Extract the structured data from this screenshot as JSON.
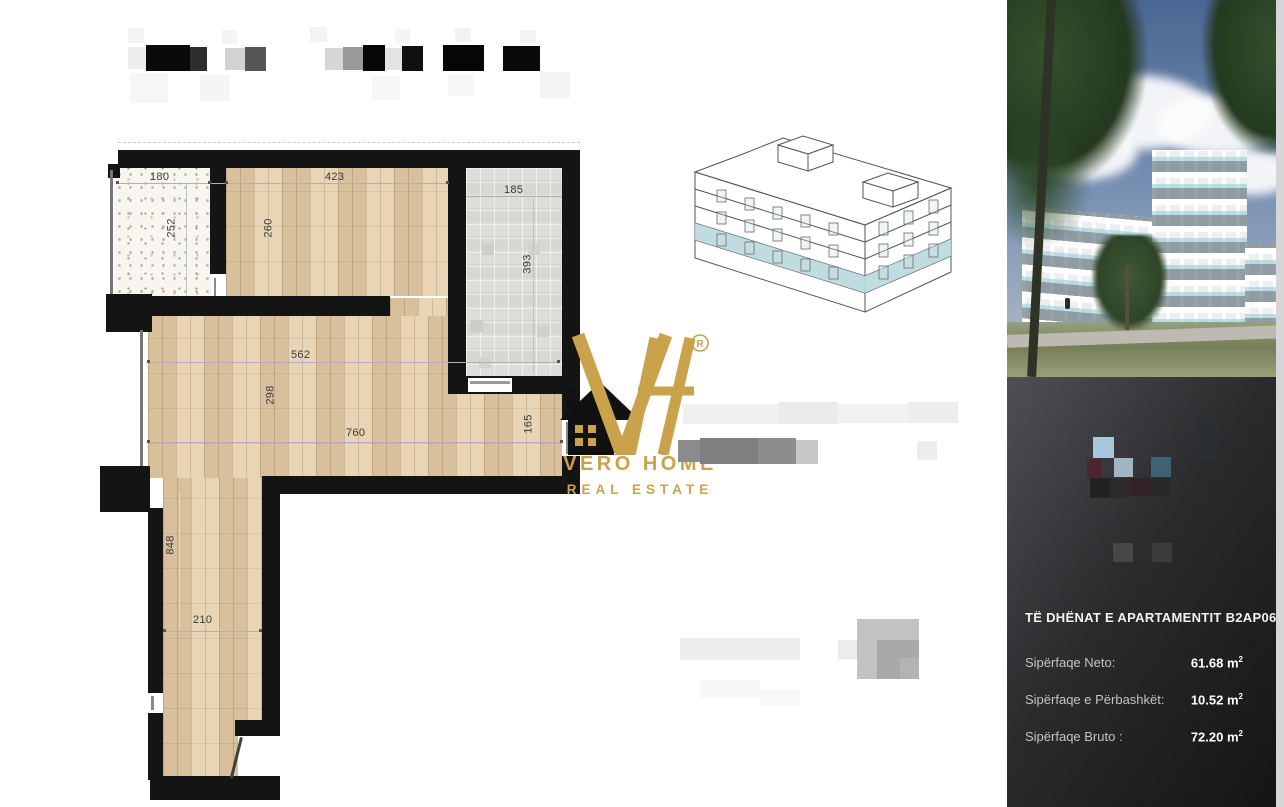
{
  "colors": {
    "gold": "#c9a24b",
    "wall_black": "#141414",
    "floor_wood": "#e6d0ae",
    "highlight_band": "#b9d8de",
    "panel_dark": "#2b2b2e"
  },
  "logo": {
    "monogram": "VH",
    "registered": "R",
    "line1": "VERO HOME",
    "line2": "REAL ESTATE"
  },
  "building_sketch": {
    "type": "axonometric-line-drawing",
    "highlight_band_color": "#b9d8de"
  },
  "floor_plan": {
    "dims": [
      "180",
      "423",
      "185",
      "252",
      "260",
      "393",
      "562",
      "298",
      "760",
      "165",
      "848",
      "210"
    ],
    "walls": [
      {
        "x": 118,
        "y": 150,
        "w": 462,
        "h": 18
      },
      {
        "x": 108,
        "y": 164,
        "w": 12,
        "h": 14
      },
      {
        "x": 110,
        "y": 170,
        "w": 3,
        "h": 136,
        "c": "#777777"
      },
      {
        "x": 106,
        "y": 294,
        "w": 46,
        "h": 38
      },
      {
        "x": 210,
        "y": 168,
        "w": 16,
        "h": 106
      },
      {
        "x": 214,
        "y": 278,
        "w": 2,
        "h": 18,
        "c": "#888888"
      },
      {
        "x": 448,
        "y": 150,
        "w": 18,
        "h": 240
      },
      {
        "x": 562,
        "y": 150,
        "w": 18,
        "h": 270
      },
      {
        "x": 562,
        "y": 456,
        "w": 18,
        "h": 38
      },
      {
        "x": 566,
        "y": 422,
        "w": 3,
        "h": 32,
        "c": "#888888"
      },
      {
        "x": 112,
        "y": 296,
        "w": 278,
        "h": 20
      },
      {
        "x": 448,
        "y": 376,
        "w": 132,
        "h": 18
      },
      {
        "x": 468,
        "y": 378,
        "w": 44,
        "h": 14,
        "c": "#ffffff"
      },
      {
        "x": 470,
        "y": 381,
        "w": 40,
        "h": 3,
        "c": "#999999"
      },
      {
        "x": 140,
        "y": 330,
        "w": 3,
        "h": 138,
        "c": "#777777"
      },
      {
        "x": 100,
        "y": 466,
        "w": 50,
        "h": 46
      },
      {
        "x": 262,
        "y": 476,
        "w": 318,
        "h": 18
      },
      {
        "x": 262,
        "y": 476,
        "w": 18,
        "h": 252
      },
      {
        "x": 235,
        "y": 720,
        "w": 45,
        "h": 16
      },
      {
        "x": 238,
        "y": 736,
        "w": 24,
        "h": 44,
        "c": "#ffffff"
      },
      {
        "x": 148,
        "y": 508,
        "w": 15,
        "h": 272
      },
      {
        "x": 150,
        "y": 776,
        "w": 130,
        "h": 24
      },
      {
        "x": 148,
        "y": 693,
        "w": 15,
        "h": 20,
        "c": "#ffffff"
      },
      {
        "x": 151,
        "y": 696,
        "w": 3,
        "h": 14,
        "c": "#888888"
      }
    ],
    "fixtures": [
      {
        "x": 482,
        "y": 243,
        "w": 12,
        "h": 12,
        "c": "#cdcdc9"
      },
      {
        "x": 528,
        "y": 243,
        "w": 12,
        "h": 12,
        "c": "#d2d2ce"
      },
      {
        "x": 470,
        "y": 320,
        "w": 13,
        "h": 12,
        "c": "#cdcdc9"
      },
      {
        "x": 537,
        "y": 326,
        "w": 12,
        "h": 11,
        "c": "#d0d0cc"
      },
      {
        "x": 479,
        "y": 357,
        "w": 12,
        "h": 11,
        "c": "#d2d2ce"
      }
    ],
    "lines": [
      {
        "x": 117,
        "y": 183,
        "w": 331,
        "h": 1,
        "c": "#b0b0b0"
      },
      {
        "x": 466,
        "y": 196,
        "w": 96,
        "h": 1,
        "c": "#b0b0b0"
      },
      {
        "x": 148,
        "y": 362,
        "w": 412,
        "h": 1,
        "c": "#b0b0b0"
      },
      {
        "x": 148,
        "y": 442,
        "w": 414,
        "h": 1,
        "c": "#b0b0b0"
      },
      {
        "x": 163,
        "y": 631,
        "w": 99,
        "h": 1,
        "c": "#b0b0b0"
      },
      {
        "x": 186,
        "y": 184,
        "w": 1,
        "h": 112,
        "c": "#c0c0c0"
      },
      {
        "x": 533,
        "y": 198,
        "w": 1,
        "h": 176,
        "c": "#c0c0c0"
      },
      {
        "x": 277,
        "y": 363,
        "w": 1,
        "h": 79,
        "c": "#c0c0c0"
      },
      {
        "x": 179,
        "y": 492,
        "w": 1,
        "h": 138,
        "c": "#d8d8d8"
      },
      {
        "x": 116,
        "y": 181,
        "w": 3,
        "h": 3,
        "c": "#555555"
      },
      {
        "x": 208,
        "y": 181,
        "w": 3,
        "h": 3,
        "c": "#555555"
      },
      {
        "x": 225,
        "y": 181,
        "w": 3,
        "h": 3,
        "c": "#555555"
      },
      {
        "x": 446,
        "y": 181,
        "w": 3,
        "h": 3,
        "c": "#555555"
      },
      {
        "x": 147,
        "y": 360,
        "w": 3,
        "h": 3,
        "c": "#555555"
      },
      {
        "x": 557,
        "y": 360,
        "w": 3,
        "h": 3,
        "c": "#555555"
      },
      {
        "x": 147,
        "y": 440,
        "w": 3,
        "h": 3,
        "c": "#555555"
      },
      {
        "x": 560,
        "y": 440,
        "w": 3,
        "h": 3,
        "c": "#555555"
      },
      {
        "x": 163,
        "y": 629,
        "w": 3,
        "h": 3,
        "c": "#555555"
      },
      {
        "x": 259,
        "y": 629,
        "w": 3,
        "h": 3,
        "c": "#555555"
      }
    ]
  },
  "redactions": {
    "header": [
      {
        "x": 128,
        "y": 28,
        "w": 16,
        "h": 15,
        "c": "#f3f3f3"
      },
      {
        "x": 222,
        "y": 30,
        "w": 15,
        "h": 14,
        "c": "#f4f4f4"
      },
      {
        "x": 310,
        "y": 27,
        "w": 17,
        "h": 15,
        "c": "#f3f3f3"
      },
      {
        "x": 395,
        "y": 29,
        "w": 15,
        "h": 14,
        "c": "#f5f5f5"
      },
      {
        "x": 455,
        "y": 28,
        "w": 16,
        "h": 14,
        "c": "#f2f2f2"
      },
      {
        "x": 520,
        "y": 30,
        "w": 16,
        "h": 14,
        "c": "#f4f4f4"
      },
      {
        "x": 128,
        "y": 47,
        "w": 18,
        "h": 22,
        "c": "#ededed"
      },
      {
        "x": 146,
        "y": 45,
        "w": 44,
        "h": 26,
        "c": "#0a0a0a"
      },
      {
        "x": 190,
        "y": 47,
        "w": 17,
        "h": 24,
        "c": "#2e2e2e"
      },
      {
        "x": 225,
        "y": 48,
        "w": 20,
        "h": 22,
        "c": "#d2d2d2"
      },
      {
        "x": 245,
        "y": 47,
        "w": 21,
        "h": 24,
        "c": "#565656"
      },
      {
        "x": 325,
        "y": 48,
        "w": 18,
        "h": 22,
        "c": "#d6d6d6"
      },
      {
        "x": 343,
        "y": 47,
        "w": 20,
        "h": 23,
        "c": "#9a9a9a"
      },
      {
        "x": 363,
        "y": 45,
        "w": 22,
        "h": 26,
        "c": "#070707"
      },
      {
        "x": 385,
        "y": 48,
        "w": 17,
        "h": 22,
        "c": "#e3e3e3"
      },
      {
        "x": 402,
        "y": 46,
        "w": 21,
        "h": 25,
        "c": "#101010"
      },
      {
        "x": 443,
        "y": 45,
        "w": 41,
        "h": 26,
        "c": "#060606"
      },
      {
        "x": 503,
        "y": 46,
        "w": 37,
        "h": 25,
        "c": "#090909"
      },
      {
        "x": 130,
        "y": 73,
        "w": 38,
        "h": 30,
        "c": "#f6f6f6"
      },
      {
        "x": 200,
        "y": 75,
        "w": 30,
        "h": 26,
        "c": "#f5f5f5"
      },
      {
        "x": 372,
        "y": 76,
        "w": 28,
        "h": 24,
        "c": "#f6f6f6"
      },
      {
        "x": 448,
        "y": 74,
        "w": 26,
        "h": 22,
        "c": "#f6f6f6"
      },
      {
        "x": 540,
        "y": 72,
        "w": 30,
        "h": 26,
        "c": "#f5f5f5"
      }
    ],
    "middle": [
      {
        "x": 683,
        "y": 404,
        "w": 120,
        "h": 20,
        "c": "#f0f0f0"
      },
      {
        "x": 778,
        "y": 402,
        "w": 60,
        "h": 22,
        "c": "#ebebeb"
      },
      {
        "x": 838,
        "y": 404,
        "w": 70,
        "h": 19,
        "c": "#f1f1f1"
      },
      {
        "x": 908,
        "y": 402,
        "w": 50,
        "h": 21,
        "c": "#eeeeee"
      },
      {
        "x": 678,
        "y": 440,
        "w": 22,
        "h": 22,
        "c": "#8b8b8b"
      },
      {
        "x": 700,
        "y": 438,
        "w": 58,
        "h": 26,
        "c": "#7f7f7f"
      },
      {
        "x": 758,
        "y": 438,
        "w": 38,
        "h": 26,
        "c": "#8d8d8d"
      },
      {
        "x": 796,
        "y": 440,
        "w": 22,
        "h": 24,
        "c": "#c7c7c7"
      },
      {
        "x": 917,
        "y": 441,
        "w": 20,
        "h": 19,
        "c": "#ededed"
      }
    ],
    "bottom": [
      {
        "x": 680,
        "y": 638,
        "w": 120,
        "h": 22,
        "c": "#ededed"
      },
      {
        "x": 838,
        "y": 640,
        "w": 19,
        "h": 19,
        "c": "#ececec"
      },
      {
        "x": 857,
        "y": 619,
        "w": 62,
        "h": 60,
        "c": "#c3c3c3"
      },
      {
        "x": 877,
        "y": 640,
        "w": 42,
        "h": 39,
        "c": "#a9a9a9"
      },
      {
        "x": 900,
        "y": 658,
        "w": 19,
        "h": 21,
        "c": "#b3b3b3"
      },
      {
        "x": 700,
        "y": 680,
        "w": 60,
        "h": 18,
        "c": "#f7f7f7"
      },
      {
        "x": 760,
        "y": 690,
        "w": 40,
        "h": 16,
        "c": "#f8f8f8"
      }
    ]
  },
  "side_panel": {
    "title": "TË DHËNAT E APARTAMENTIT B2AP06",
    "rows": [
      {
        "label": "Sipërfaqe Neto:",
        "value": "61.68",
        "unit": "m",
        "sup": "2"
      },
      {
        "label": "Sipërfaqe e Përbashkët:",
        "value": "10.52",
        "unit": "m",
        "sup": "2"
      },
      {
        "label": "Sipërfaqe Bruto :",
        "value": "72.20",
        "unit": "m",
        "sup": "2"
      }
    ],
    "pixel_logo": [
      {
        "x": 1197,
        "y": 418,
        "w": 18,
        "h": 42,
        "c": "#2b2e33"
      },
      {
        "x": 1093,
        "y": 437,
        "w": 21,
        "h": 21,
        "c": "#a9c7dd"
      },
      {
        "x": 1087,
        "y": 459,
        "w": 14,
        "h": 19,
        "c": "#4a2730"
      },
      {
        "x": 1114,
        "y": 458,
        "w": 19,
        "h": 19,
        "c": "#9fb6c2"
      },
      {
        "x": 1151,
        "y": 457,
        "w": 20,
        "h": 20,
        "c": "#3c6273"
      },
      {
        "x": 1090,
        "y": 478,
        "w": 20,
        "h": 20,
        "c": "#222224"
      },
      {
        "x": 1110,
        "y": 478,
        "w": 20,
        "h": 20,
        "c": "#2e2a2c"
      },
      {
        "x": 1130,
        "y": 478,
        "w": 20,
        "h": 18,
        "c": "#322426"
      },
      {
        "x": 1150,
        "y": 478,
        "w": 20,
        "h": 18,
        "c": "#26282a"
      },
      {
        "x": 1113,
        "y": 543,
        "w": 21,
        "h": 19,
        "c": "#47474a"
      },
      {
        "x": 1133,
        "y": 543,
        "w": 20,
        "h": 19,
        "c": "#2c2c2e"
      },
      {
        "x": 1152,
        "y": 543,
        "w": 20,
        "h": 19,
        "c": "#3c3c3f"
      }
    ]
  }
}
